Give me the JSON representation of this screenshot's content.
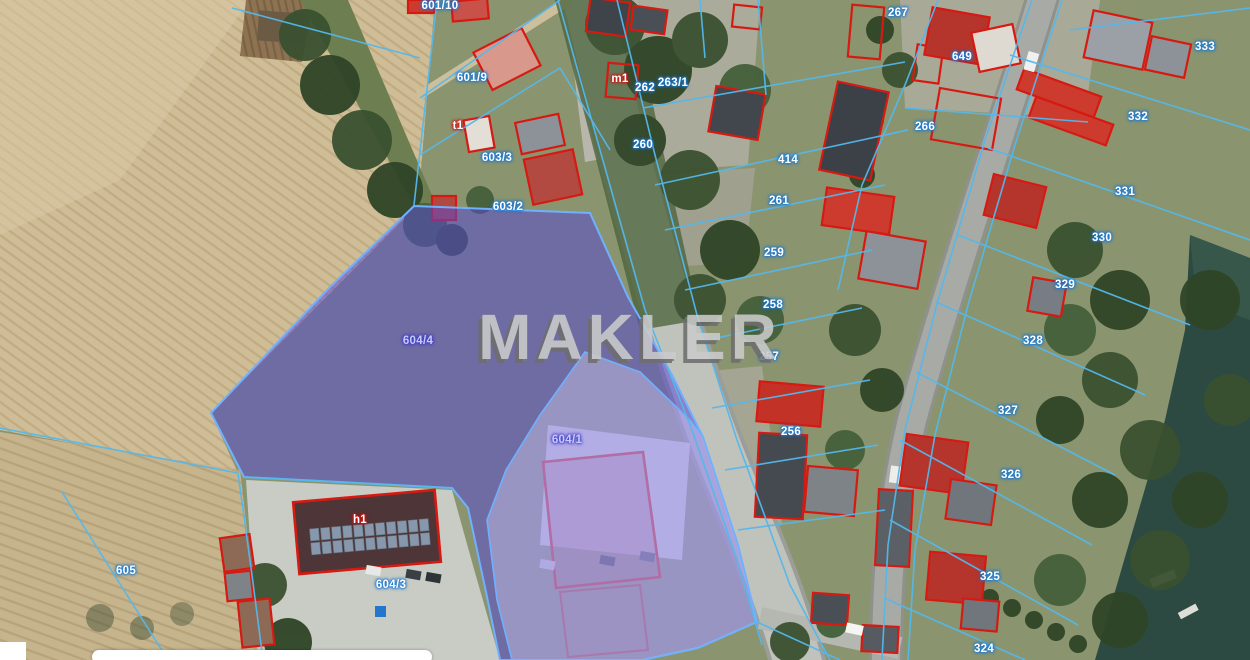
{
  "watermark": {
    "text": "MAKLER"
  },
  "map": {
    "labels": [
      {
        "text": "601/10",
        "x": 440,
        "y": 6,
        "kind": "parcel"
      },
      {
        "text": "601/9",
        "x": 472,
        "y": 78,
        "kind": "parcel"
      },
      {
        "text": "603/3",
        "x": 497,
        "y": 158,
        "kind": "parcel"
      },
      {
        "text": "603/2",
        "x": 508,
        "y": 207,
        "kind": "parcel"
      },
      {
        "text": "m1",
        "x": 620,
        "y": 79,
        "kind": "building"
      },
      {
        "text": "t1",
        "x": 458,
        "y": 126,
        "kind": "building"
      },
      {
        "text": "h1",
        "x": 360,
        "y": 520,
        "kind": "building"
      },
      {
        "text": "262",
        "x": 645,
        "y": 88,
        "kind": "parcel"
      },
      {
        "text": "263/1",
        "x": 673,
        "y": 83,
        "kind": "parcel"
      },
      {
        "text": "260",
        "x": 643,
        "y": 145,
        "kind": "parcel"
      },
      {
        "text": "267",
        "x": 898,
        "y": 13,
        "kind": "parcel"
      },
      {
        "text": "649",
        "x": 962,
        "y": 57,
        "kind": "parcel"
      },
      {
        "text": "266",
        "x": 925,
        "y": 127,
        "kind": "parcel"
      },
      {
        "text": "414",
        "x": 788,
        "y": 160,
        "kind": "parcel"
      },
      {
        "text": "261",
        "x": 779,
        "y": 201,
        "kind": "parcel"
      },
      {
        "text": "259",
        "x": 774,
        "y": 253,
        "kind": "parcel"
      },
      {
        "text": "258",
        "x": 773,
        "y": 305,
        "kind": "parcel"
      },
      {
        "text": "257",
        "x": 769,
        "y": 357,
        "kind": "parcel"
      },
      {
        "text": "256",
        "x": 791,
        "y": 432,
        "kind": "parcel"
      },
      {
        "text": "333",
        "x": 1205,
        "y": 47,
        "kind": "parcel"
      },
      {
        "text": "332",
        "x": 1138,
        "y": 117,
        "kind": "parcel"
      },
      {
        "text": "331",
        "x": 1125,
        "y": 192,
        "kind": "parcel"
      },
      {
        "text": "330",
        "x": 1102,
        "y": 238,
        "kind": "parcel"
      },
      {
        "text": "329",
        "x": 1065,
        "y": 285,
        "kind": "parcel"
      },
      {
        "text": "328",
        "x": 1033,
        "y": 341,
        "kind": "parcel"
      },
      {
        "text": "327",
        "x": 1008,
        "y": 411,
        "kind": "parcel"
      },
      {
        "text": "326",
        "x": 1011,
        "y": 475,
        "kind": "parcel"
      },
      {
        "text": "325",
        "x": 990,
        "y": 577,
        "kind": "parcel"
      },
      {
        "text": "324",
        "x": 984,
        "y": 649,
        "kind": "parcel"
      },
      {
        "text": "605",
        "x": 126,
        "y": 571,
        "kind": "parcel"
      },
      {
        "text": "604/3",
        "x": 391,
        "y": 585,
        "kind": "parcel"
      },
      {
        "text": "604/4",
        "x": 418,
        "y": 341,
        "kind": "highlight"
      },
      {
        "text": "604/1",
        "x": 567,
        "y": 440,
        "kind": "highlight"
      }
    ],
    "colors": {
      "cadastral_line": "#54b8ec",
      "building_outline": "#d61a12",
      "highlight_fill": "#5747d2",
      "highlight_fill_light": "#9b91e2",
      "water": "#2c4a41",
      "road": "#c0c2bc",
      "farmland": "#cfbd97",
      "watermark_color": "#cbcbcb"
    }
  }
}
